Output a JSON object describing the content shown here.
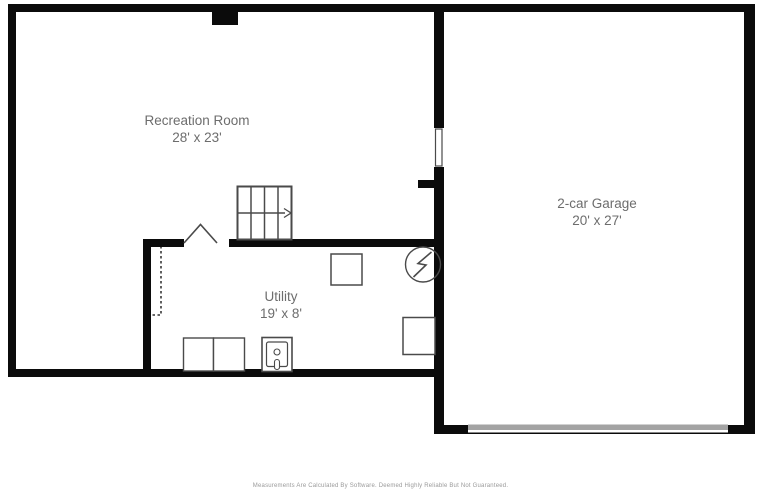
{
  "plan": {
    "title": "Basement floor plan",
    "rooms": [
      {
        "name": "Recreation Room",
        "dimensions": "28' x 23'"
      },
      {
        "name": "2-car Garage",
        "dimensions": "20' x 27'"
      },
      {
        "name": "Utility",
        "dimensions": "19' x 8'"
      }
    ],
    "fixtures": [
      {
        "icon": "stairs-icon",
        "meaning": "staircase with direction arrow"
      },
      {
        "icon": "door-opening-icon",
        "meaning": "doorway caret marker"
      },
      {
        "icon": "electrical-panel-icon",
        "meaning": "circle with lightning bolt"
      },
      {
        "icon": "washer-icon",
        "meaning": "laundry appliance square"
      },
      {
        "icon": "dryer-icon",
        "meaning": "laundry appliance square"
      },
      {
        "icon": "utility-sink-icon",
        "meaning": "sink with drain and faucet"
      },
      {
        "icon": "water-heater-icon",
        "meaning": "fixture square"
      },
      {
        "icon": "fixture-square-icon",
        "meaning": "fixture square"
      },
      {
        "icon": "window-icon",
        "meaning": "window in garage wall"
      },
      {
        "icon": "garage-door-icon",
        "meaning": "gray garage door band"
      },
      {
        "icon": "dashed-outline-icon",
        "meaning": "dashed under-stair outline"
      }
    ],
    "footer": "Measurements Are Calculated By Software. Deemed Highly Reliable But Not Guaranteed."
  },
  "colors": {
    "background": "#ffffff",
    "wall": "#0b0b0b",
    "label_text": "#6d6d6d",
    "fixture_outline": "#4a4a4a",
    "garage_door": "#a3a3a3",
    "footer_text": "#9a9a9a"
  }
}
